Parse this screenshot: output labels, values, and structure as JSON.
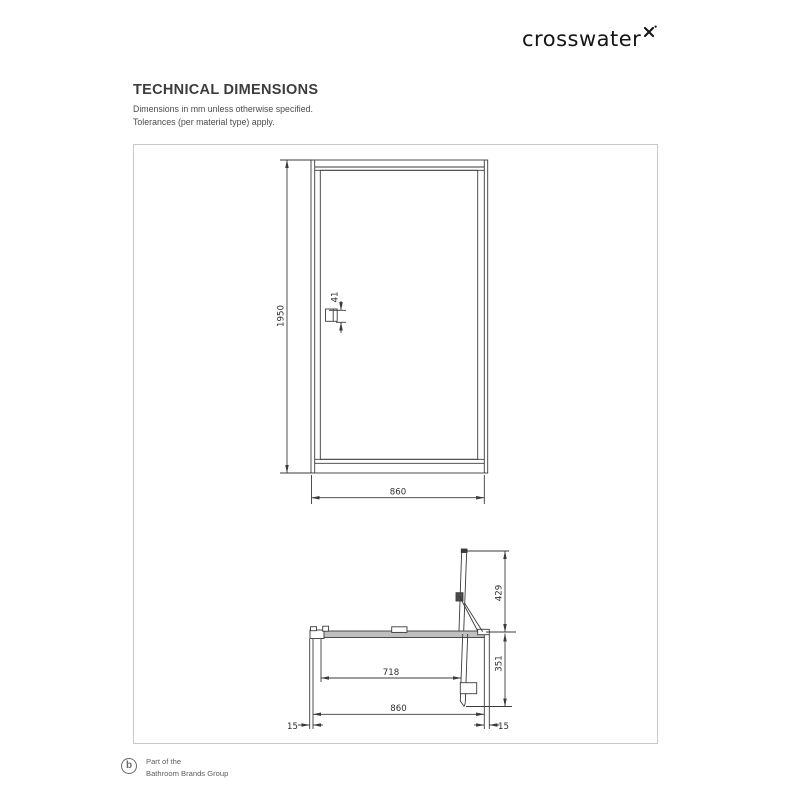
{
  "brand": {
    "name": "crosswater"
  },
  "header": {
    "title": "TECHNICAL DIMENSIONS",
    "note1": "Dimensions in mm unless otherwise specified.",
    "note2": "Tolerances (per material type) apply."
  },
  "drawing": {
    "units": "mm",
    "front": {
      "height": "1950",
      "width": "860",
      "handle": "41"
    },
    "plan": {
      "door_open": "429",
      "depth": "351",
      "opening": "718",
      "width": "860",
      "wall_left": "15",
      "wall_right": "15"
    }
  },
  "footer": {
    "monogram": "b",
    "line1": "Part of the",
    "line2": "Bathroom Brands Group"
  },
  "colors": {
    "line": "#3b3b3b",
    "sheet_border": "#c9c9c9",
    "heading": "#3c3c3c",
    "bar_fill": "#bfbfbf"
  }
}
